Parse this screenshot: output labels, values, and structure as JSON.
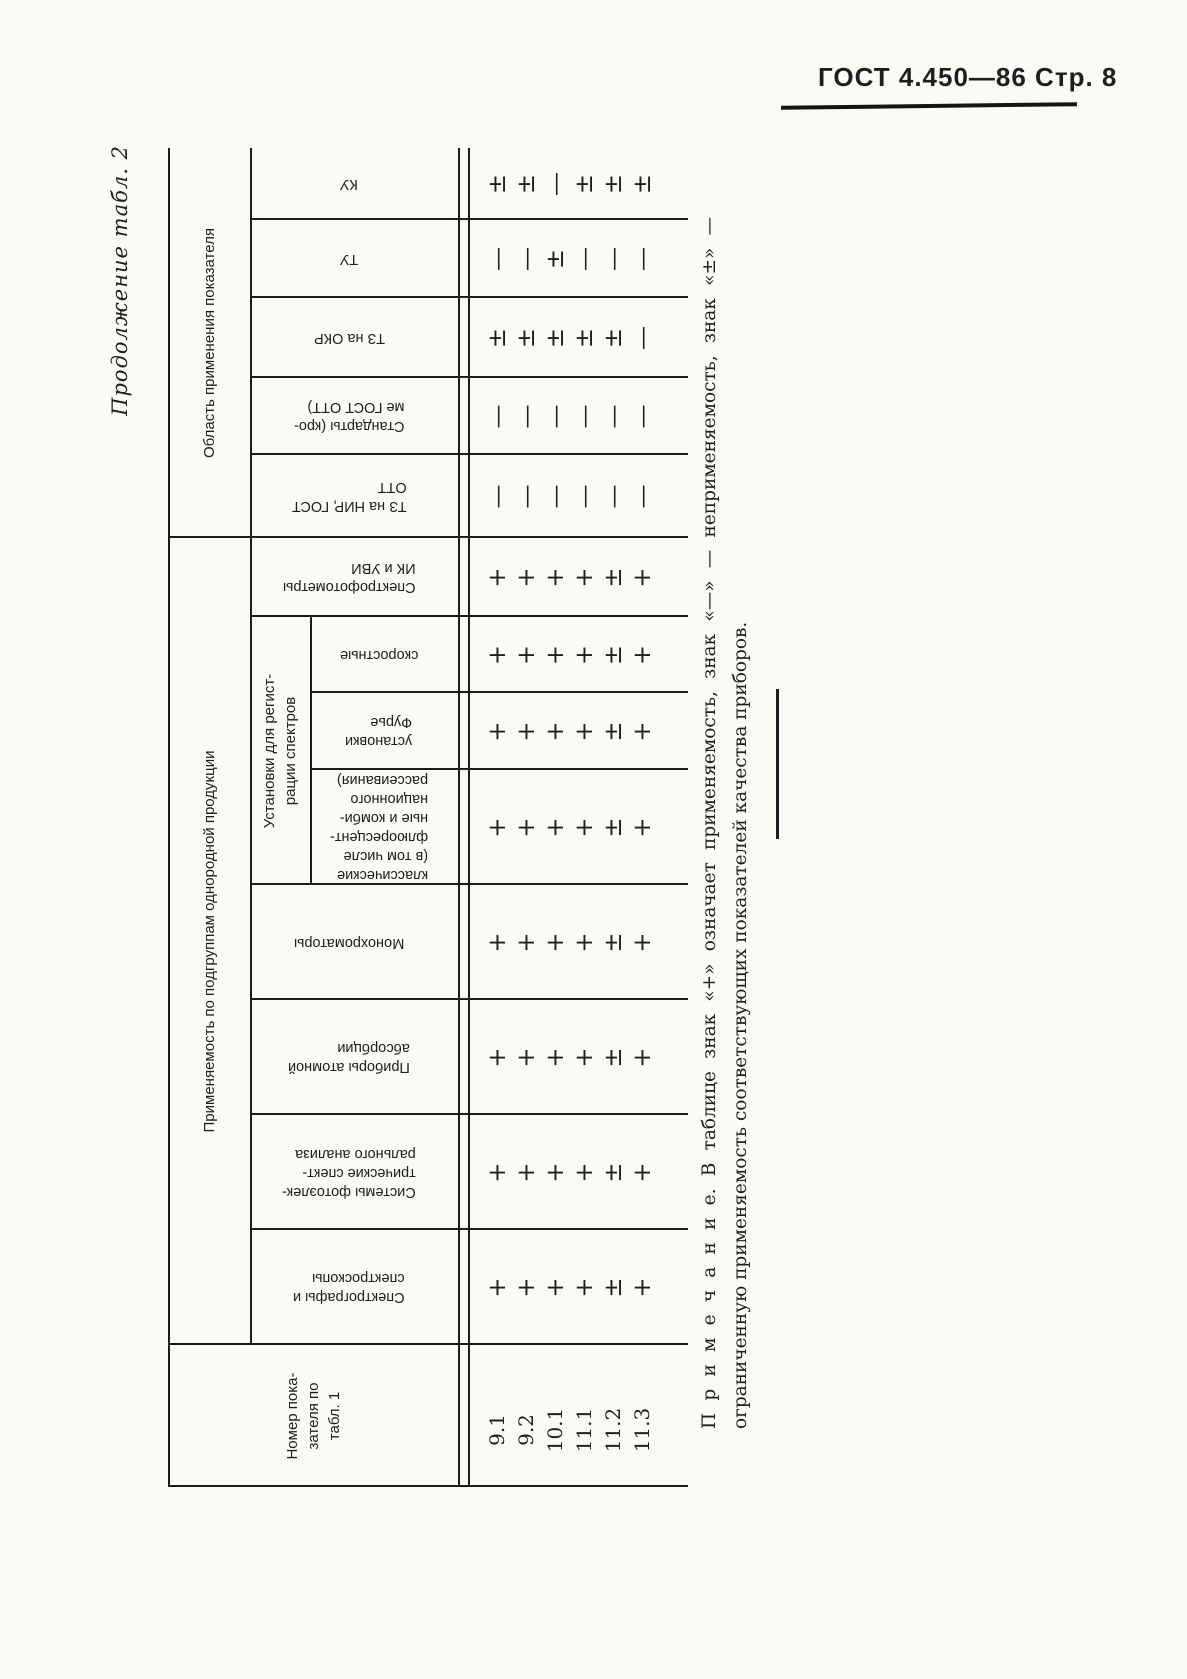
{
  "page_header": {
    "text": "ГОСТ 4.450—86 Стр. 8"
  },
  "table_caption": "Продолжение табл. 2",
  "table": {
    "row_label_header": {
      "label": "Номер показателя по табл. 1",
      "lines": [
        "Номер пока-",
        "зателя по",
        "табл. 1"
      ]
    },
    "groups": [
      {
        "label": "Применяемость по подгруппам однородной продукции"
      },
      {
        "label": "Область применения показателя"
      }
    ],
    "subgroup_header": {
      "label": "Установки для регистрации спектров",
      "lines": [
        "Установки для регист-",
        "рации спектров"
      ]
    },
    "columns": [
      {
        "label": "Спектрографы и спектроскопы",
        "lines": [
          "Спектрографы и",
          "спектроскопы"
        ],
        "group": "Применяемость по подгруппам однородной продукции",
        "sub": false
      },
      {
        "label": "Системы фотоэлектрические спектрального анализа",
        "lines": [
          "Системы фотоэлек-",
          "трические спект-",
          "рального анализа"
        ],
        "group": "Применяемость по подгруппам однородной продукции",
        "sub": false
      },
      {
        "label": "Приборы атомной абсорбции",
        "lines": [
          "Приборы атомной",
          "абсорбции"
        ],
        "group": "Применяемость по подгруппам однородной продукции",
        "sub": false
      },
      {
        "label": "Монохроматоры",
        "lines": [
          "Монохроматоры"
        ],
        "group": "Применяемость по подгруппам однородной продукции",
        "sub": false
      },
      {
        "label": "классические (в том числе флюоресцентные и комбинационного рассеивания)",
        "lines": [
          "классические",
          "(в том числе",
          "флюоресцент-",
          "ные и комби-",
          "национного",
          "рассеивания)"
        ],
        "group": "Установки для регистрации спектров",
        "sub": true
      },
      {
        "label": "установки Фурье",
        "lines": [
          "установки",
          "Фурье"
        ],
        "group": "Установки для регистрации спектров",
        "sub": true
      },
      {
        "label": "скоростные",
        "lines": [
          "скоростные"
        ],
        "group": "Установки для регистрации спектров",
        "sub": true
      },
      {
        "label": "Спектрофотометры ИК и УВИ",
        "lines": [
          "Спектрофотометры",
          "ИК и УВИ"
        ],
        "group": "Применяемость по подгруппам однородной продукции",
        "sub": false
      },
      {
        "label": "ТЗ на НИР, ГОСТ ОТТ",
        "lines": [
          "ТЗ на НИР, ГОСТ",
          "ОТТ"
        ],
        "group": "Область применения показателя",
        "sub": false
      },
      {
        "label": "Стандарты (кроме ГОСТ ОТТ)",
        "lines": [
          "Стандарты (кро-",
          "ме ГОСТ ОТТ)"
        ],
        "group": "Область применения показателя",
        "sub": false
      },
      {
        "label": "ТЗ на ОКР",
        "lines": [
          "ТЗ на ОКР"
        ],
        "group": "Область применения показателя",
        "sub": false
      },
      {
        "label": "ТУ",
        "lines": [
          "ТУ"
        ],
        "group": "Область применения показателя",
        "sub": false
      },
      {
        "label": "КУ",
        "lines": [
          "КУ"
        ],
        "group": "Область применения показателя",
        "sub": false
      }
    ],
    "rows": [
      {
        "label": "9.1",
        "marks": [
          "+",
          "+",
          "+",
          "+",
          "+",
          "+",
          "+",
          "+",
          "—",
          "—",
          "±",
          "—",
          "±"
        ]
      },
      {
        "label": "9.2",
        "marks": [
          "+",
          "+",
          "+",
          "+",
          "+",
          "+",
          "+",
          "+",
          "—",
          "—",
          "±",
          "—",
          "±"
        ]
      },
      {
        "label": "10.1",
        "marks": [
          "+",
          "+",
          "+",
          "+",
          "+",
          "+",
          "+",
          "+",
          "—",
          "—",
          "±",
          "±",
          "—"
        ]
      },
      {
        "label": "11.1",
        "marks": [
          "+",
          "+",
          "+",
          "+",
          "+",
          "+",
          "+",
          "+",
          "—",
          "—",
          "±",
          "—",
          "±"
        ]
      },
      {
        "label": "11.2",
        "marks": [
          "±",
          "±",
          "±",
          "±",
          "±",
          "±",
          "±",
          "±",
          "—",
          "—",
          "±",
          "—",
          "±"
        ]
      },
      {
        "label": "11.3",
        "marks": [
          "+",
          "+",
          "+",
          "+",
          "+",
          "+",
          "+",
          "+",
          "—",
          "—",
          "—",
          "—",
          "±"
        ]
      }
    ]
  },
  "note": {
    "line1": "П р и м е ч а н и е.  В таблице знак «+» означает применяемость, знак «—» — неприменяемость, знак «±» —",
    "line2": "ограниченную применяемость соответствующих показателей качества приборов.",
    "legend": {
      "plus": "применяемость",
      "minus": "неприменяемость",
      "plus_minus": "ограниченная применяемость"
    }
  }
}
